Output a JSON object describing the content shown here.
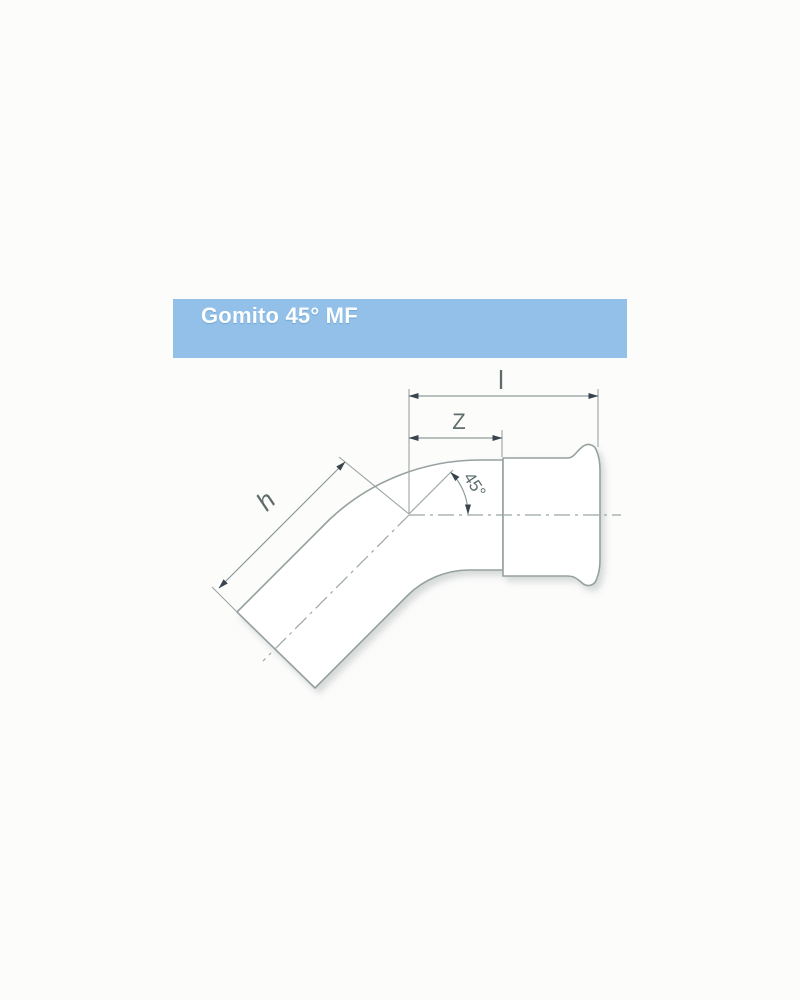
{
  "page": {
    "background_color": "#fcfcfb"
  },
  "header": {
    "title": "Gomito 45° MF",
    "bar_color": "#92c0e8",
    "title_color": "#ffffff"
  },
  "drawing": {
    "description": "Technical outline drawing of a 45-degree male x female press-fitting elbow with press socket bead on the right end",
    "dim_labels": {
      "overall_length": "l",
      "insertion_depth": "Z",
      "leg_length": "h",
      "angle": "45°"
    },
    "line_color": "#96a1a0",
    "label_color": "#5e6c6c",
    "arrow_color": "#39444e"
  }
}
